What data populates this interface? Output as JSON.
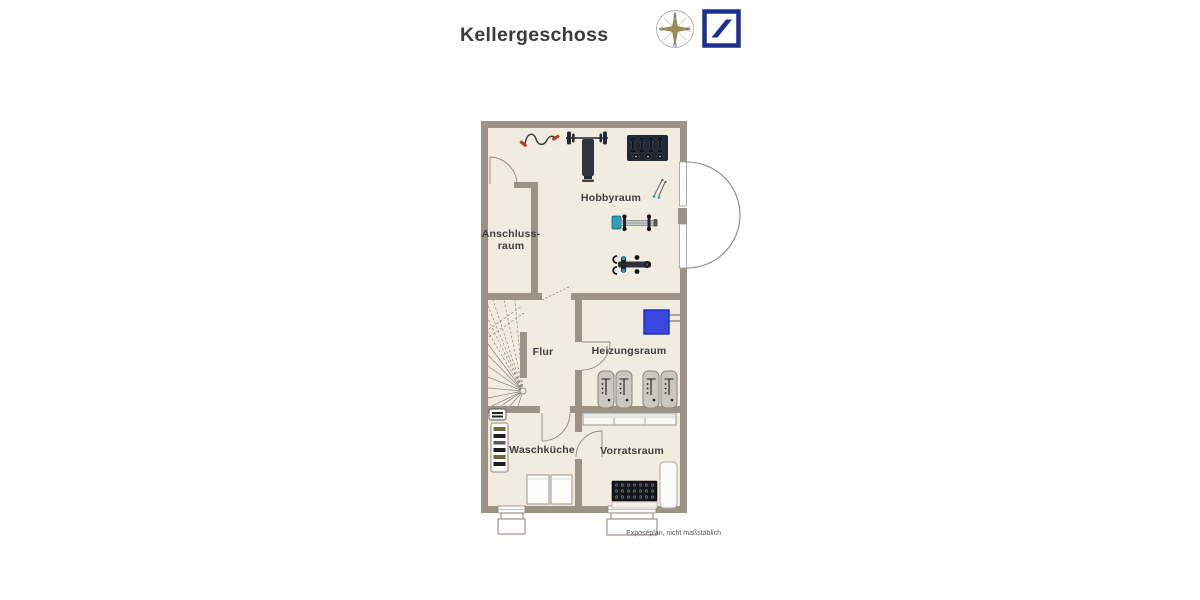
{
  "header": {
    "title": "Kellergeschoss",
    "compass": {
      "south": "S",
      "north": "N",
      "east": "O",
      "west": "W"
    },
    "logo_icon": "deutsche-bank-logo"
  },
  "floorplan": {
    "rooms": {
      "hobbyraum": {
        "label": "Hobbyraum"
      },
      "anschlussraum": {
        "line1": "Anschluss-",
        "line2": "raum"
      },
      "flur": {
        "label": "Flur"
      },
      "heizungsraum": {
        "label": "Heizungsraum"
      },
      "waschkueche": {
        "label": "Waschküche"
      },
      "vorratsraum": {
        "label": "Vorratsraum"
      }
    },
    "footnote": "Exposéplan, nicht maßstäblich",
    "icons": [
      "compass-rose-icon",
      "deutsche-bank-logo",
      "jump-rope-icon",
      "barbell-bench-icon",
      "dumbbell-rack-icon",
      "resistance-band-icon",
      "rowing-machine-icon",
      "exercise-machine-icon",
      "boiler-icon",
      "oil-tank-icon",
      "vent-icon",
      "laundry-shelf-icon",
      "washing-machine-icon",
      "storage-shelf-icon",
      "bottle-crate-icon",
      "freezer-icon",
      "staircase-icon",
      "door-arc",
      "window",
      "light-well"
    ],
    "colors": {
      "wall": "#9d9286",
      "floor": "#f1ebe0",
      "boiler_blue": "#3a46e0",
      "logo_blue": "#1c318e",
      "accent_red": "#b23d35",
      "equipment_dark": "#2b3442"
    }
  }
}
